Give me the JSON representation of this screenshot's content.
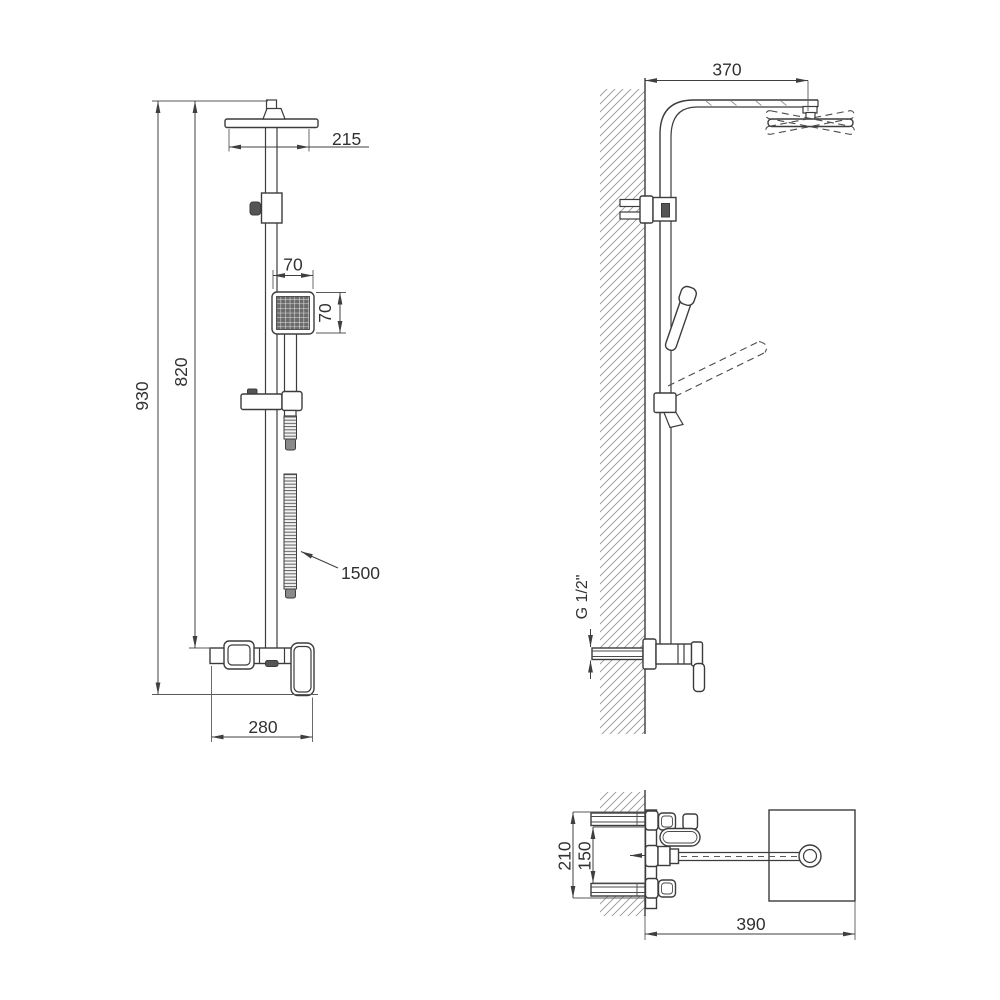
{
  "style": {
    "background": "#ffffff",
    "line_color": "#3c3c3c",
    "dimension_color": "#3f3f3f",
    "hatch_color": "#979797"
  },
  "views": {
    "front": {
      "dims": {
        "total_height": "930",
        "bar_height": "820",
        "head_width": "215",
        "hand_shower_width": "70",
        "hand_shower_height": "70",
        "hose_length": "1500",
        "mixer_width": "280"
      }
    },
    "side": {
      "dims": {
        "arm_reach": "370",
        "thread": "G 1/2\""
      }
    },
    "top": {
      "dims": {
        "body_depth": "210",
        "inlet_spacing": "150",
        "reach": "390"
      }
    }
  }
}
